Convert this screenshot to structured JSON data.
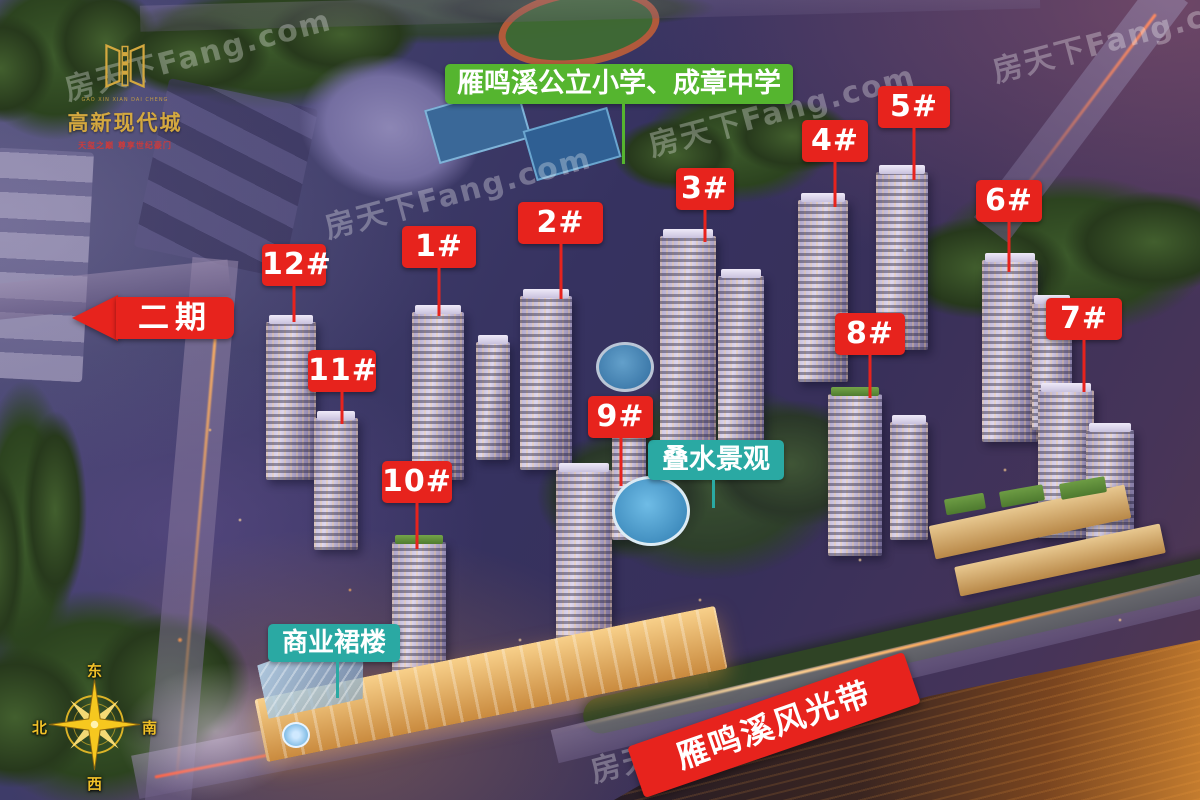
{
  "project": {
    "name": "高新现代城",
    "name_latin": "GAO XIN XIAN DAI CHENG",
    "tagline": "天玺之巅 尊享世纪豪门"
  },
  "annotations": {
    "school": "雁鸣溪公立小学、成章中学",
    "phase2": "二期",
    "water_feature": "叠水景观",
    "commercial_podium": "商业裙楼",
    "scenic_belt": "雁鸣溪风光带"
  },
  "buildings": [
    {
      "label": "12#",
      "x": 262,
      "y": 244,
      "w": 64,
      "leader": 36
    },
    {
      "label": "11#",
      "x": 308,
      "y": 350,
      "w": 68,
      "leader": 32
    },
    {
      "label": "1#",
      "x": 402,
      "y": 226,
      "w": 74,
      "leader": 48
    },
    {
      "label": "2#",
      "x": 518,
      "y": 202,
      "w": 85,
      "leader": 55
    },
    {
      "label": "3#",
      "x": 676,
      "y": 168,
      "w": 58,
      "leader": 32
    },
    {
      "label": "4#",
      "x": 802,
      "y": 120,
      "w": 66,
      "leader": 45
    },
    {
      "label": "5#",
      "x": 878,
      "y": 86,
      "w": 72,
      "leader": 52
    },
    {
      "label": "6#",
      "x": 976,
      "y": 180,
      "w": 66,
      "leader": 50
    },
    {
      "label": "7#",
      "x": 1046,
      "y": 298,
      "w": 76,
      "leader": 52
    },
    {
      "label": "8#",
      "x": 835,
      "y": 313,
      "w": 70,
      "leader": 43
    },
    {
      "label": "9#",
      "x": 588,
      "y": 396,
      "w": 65,
      "leader": 48
    },
    {
      "label": "10#",
      "x": 382,
      "y": 461,
      "w": 70,
      "leader": 46
    }
  ],
  "compass": {
    "top": "东",
    "right": "南",
    "bottom": "西",
    "left": "北"
  },
  "watermark": {
    "text": "房天下Fang.com",
    "positions": [
      {
        "x": 60,
        "y": 30
      },
      {
        "x": 320,
        "y": 168
      },
      {
        "x": 644,
        "y": 86
      },
      {
        "x": 988,
        "y": 12
      },
      {
        "x": 586,
        "y": 712
      }
    ]
  },
  "colors": {
    "label_red": "#e7231d",
    "label_green": "#55b52f",
    "label_teal": "#2aa9a3",
    "gold": "#d4a83f",
    "tagline_red": "#cf3a3a"
  }
}
